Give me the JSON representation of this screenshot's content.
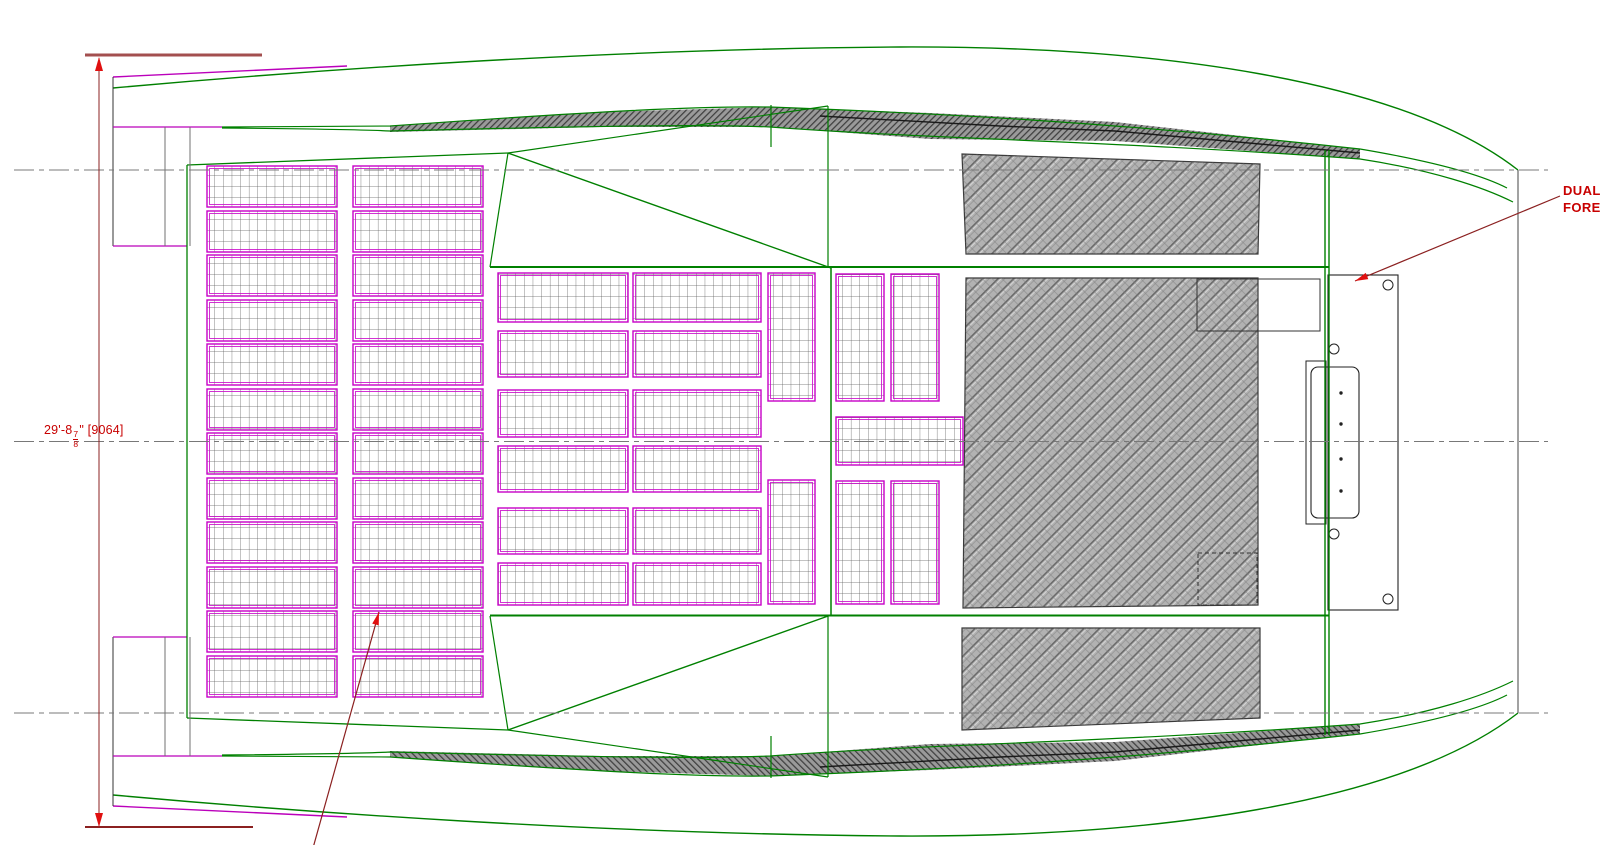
{
  "meta": {
    "width": 1600,
    "height": 845,
    "background": "#ffffff",
    "drawing_type": "catamaran deck plan CAD drawing"
  },
  "colors": {
    "hull_green": "#008000",
    "hull_magenta": "#BB00BB",
    "panel_magenta": "#C800C8",
    "dim_line": "#8B2020",
    "dim_bar": "#A34F4F",
    "arrow_red": "#E01010",
    "text_red": "#C80000",
    "centerline_gray": "#787878",
    "plate_black": "#222222",
    "hatch_base": "#b2b2b2",
    "hatch_dark_base": "#9a9a9a"
  },
  "texts": {
    "dim_whole": "29'-8",
    "dim_frac_num": "7",
    "dim_frac_den": "8",
    "dim_suffix": "\" [9064]",
    "callout_line1": "DUAL",
    "callout_line2": "FORE"
  },
  "centerlines": {
    "ys": [
      170,
      441.5,
      713
    ],
    "x1": 14,
    "x2": 1548,
    "dash": "20 5 5 5",
    "color": "#787878"
  },
  "dimension": {
    "vline": {
      "x": 99,
      "y1": 58,
      "y2": 826
    },
    "top_bar": {
      "x1": 85,
      "y1": 55,
      "x2": 262,
      "y2": 55,
      "sw": 3
    },
    "bottom_bar": {
      "x1": 85,
      "y1": 827,
      "x2": 253,
      "y2": 827,
      "sw": 2
    },
    "arrow_up": "99,57 95,71 103,71",
    "arrow_down": "99,827 95,813 103,813"
  },
  "leaders": [
    {
      "x1": 1560,
      "y1": 196,
      "x2": 1355,
      "y2": 281,
      "name": "leader-dual-fore"
    },
    {
      "x1": 313,
      "y1": 848,
      "x2": 379,
      "y2": 612,
      "name": "leader-deck-panel"
    }
  ],
  "panels": {
    "columns": [
      {
        "x": 207,
        "w": 130,
        "rows": [
          [
            166,
            41
          ],
          [
            211,
            41
          ],
          [
            255,
            41
          ],
          [
            300,
            41
          ],
          [
            344,
            41
          ],
          [
            389,
            41
          ],
          [
            433,
            41
          ],
          [
            478,
            41
          ],
          [
            522,
            41
          ],
          [
            567,
            41
          ],
          [
            611,
            41
          ],
          [
            656,
            41
          ]
        ]
      },
      {
        "x": 353,
        "w": 130,
        "rows": [
          [
            166,
            41
          ],
          [
            211,
            41
          ],
          [
            255,
            41
          ],
          [
            300,
            41
          ],
          [
            344,
            41
          ],
          [
            389,
            41
          ],
          [
            433,
            41
          ],
          [
            478,
            41
          ],
          [
            522,
            41
          ],
          [
            567,
            41
          ],
          [
            611,
            41
          ],
          [
            656,
            41
          ]
        ]
      },
      {
        "x": 498,
        "w": 130,
        "rows": [
          [
            273,
            49
          ],
          [
            331,
            46
          ],
          [
            390,
            47
          ],
          [
            446,
            46
          ],
          [
            508,
            46
          ],
          [
            563,
            42
          ]
        ]
      },
      {
        "x": 633,
        "w": 128,
        "rows": [
          [
            273,
            49
          ],
          [
            331,
            46
          ],
          [
            390,
            47
          ],
          [
            446,
            46
          ],
          [
            508,
            46
          ],
          [
            563,
            42
          ]
        ]
      },
      {
        "x": 768,
        "w": 47,
        "rows": [
          [
            273,
            128
          ],
          [
            480,
            124
          ]
        ]
      },
      {
        "x": 836,
        "w": 48,
        "rows": [
          [
            274,
            127
          ],
          [
            481,
            123
          ]
        ]
      },
      {
        "x": 891,
        "w": 48,
        "rows": [
          [
            274,
            127
          ],
          [
            481,
            123
          ]
        ]
      }
    ],
    "singles": [
      {
        "x": 836,
        "y": 417,
        "w": 127,
        "h": 48
      }
    ]
  },
  "gray_regions": [
    {
      "pts": "962,154 1260,164 1258,254 966,254",
      "name": "roof-hatch-top"
    },
    {
      "pts": "966,278 1258,278 1258,605 963,608",
      "name": "roof-hatch-main"
    },
    {
      "pts": "962,628 1260,628 1260,718 962,730",
      "name": "roof-hatch-bottom"
    }
  ],
  "hull": {
    "mirror_axis": 883,
    "half_elements": [
      {
        "t": "polygon",
        "pts": "390,126 600,112 770,107 930,113 1115,122 1360,149 1360,159 1115,141 930,139 770,127 600,127 390,132",
        "f": "url(#pHatchD)",
        "n": "sidedeck-hatch"
      },
      {
        "t": "polyline",
        "pts": "820,116 1000,126 1115,131 1360,153",
        "s": "#1a1a1a",
        "sw": 1.4,
        "n": "sidedeck-edge-line"
      },
      {
        "t": "path",
        "d": "M113,88 C300,71 600,49 900,47 C1150,46 1400,78 1518,170",
        "s": "#008000",
        "sw": 1.4,
        "n": "hull-sheer-line"
      },
      {
        "t": "line",
        "x1": 113,
        "y1": 77,
        "x2": 347,
        "y2": 66,
        "s": "#BB00BB",
        "sw": 1.4,
        "n": "hull-sheer-magenta"
      },
      {
        "t": "path",
        "d": "M222,127 C330,126 370,126 390,126 C600,111 700,106 770,107 C930,113 1115,122 1360,149 C1425,160 1478,173 1507,188",
        "s": "#008000",
        "sw": 1.2,
        "n": "hull-inner-line"
      },
      {
        "t": "path",
        "d": "M222,128 C330,129 370,130 390,131 C600,126 700,124 770,127 C930,139 1115,141 1360,159 C1432,170 1483,187 1513,202",
        "s": "#008000",
        "sw": 1.2,
        "n": "hull-inner-line"
      },
      {
        "t": "line",
        "x1": 187,
        "y1": 165,
        "x2": 508,
        "y2": 153,
        "s": "#008000",
        "sw": 1.3,
        "n": "deck-edge-line"
      },
      {
        "t": "line",
        "x1": 508,
        "y1": 153,
        "x2": 490,
        "y2": 267,
        "s": "#008000",
        "sw": 1.2,
        "n": "deck-brace-line"
      },
      {
        "t": "line",
        "x1": 508,
        "y1": 153,
        "x2": 831,
        "y2": 268,
        "s": "#008000",
        "sw": 1.4,
        "n": "deck-diagonal-line"
      },
      {
        "t": "line",
        "x1": 508,
        "y1": 153,
        "x2": 828,
        "y2": 106,
        "s": "#008000",
        "sw": 1.2,
        "n": "deck-brace-line"
      },
      {
        "t": "line",
        "x1": 828,
        "y1": 106,
        "x2": 828,
        "y2": 267,
        "s": "#008000",
        "sw": 1.2,
        "n": "beam-edge-line"
      },
      {
        "t": "line",
        "x1": 113,
        "y1": 77,
        "x2": 113,
        "y2": 246,
        "s": "#333333",
        "sw": 1,
        "n": "transom-line"
      },
      {
        "t": "line",
        "x1": 113,
        "y1": 127,
        "x2": 222,
        "y2": 127,
        "s": "#BB00BB",
        "sw": 1.3,
        "n": "transom-magenta-line"
      },
      {
        "t": "line",
        "x1": 113,
        "y1": 246,
        "x2": 187,
        "y2": 246,
        "s": "#BB00BB",
        "sw": 1.3,
        "n": "transom-magenta-line"
      },
      {
        "t": "line",
        "x1": 165,
        "y1": 127,
        "x2": 165,
        "y2": 246,
        "s": "#707070",
        "sw": 1,
        "n": "transom-divider"
      },
      {
        "t": "line",
        "x1": 190,
        "y1": 127,
        "x2": 190,
        "y2": 246,
        "s": "#707070",
        "sw": 1,
        "n": "transom-divider"
      },
      {
        "t": "line",
        "x1": 771,
        "y1": 105,
        "x2": 771,
        "y2": 147,
        "s": "#008000",
        "sw": 1.2,
        "n": "beam-crossing-mark"
      }
    ],
    "static_elements": [
      {
        "t": "line",
        "x1": 187,
        "y1": 165,
        "x2": 187,
        "y2": 718,
        "s": "#008000",
        "sw": 1.3,
        "n": "deck-left-edge"
      },
      {
        "t": "line",
        "x1": 490,
        "y1": 267,
        "x2": 1329,
        "y2": 267,
        "s": "#008000",
        "sw": 2,
        "n": "deck-top-edge"
      },
      {
        "t": "line",
        "x1": 490,
        "y1": 615.5,
        "x2": 1329,
        "y2": 615.5,
        "s": "#008000",
        "sw": 2,
        "n": "deck-bottom-edge"
      },
      {
        "t": "line",
        "x1": 831,
        "y1": 267,
        "x2": 831,
        "y2": 616,
        "s": "#008000",
        "sw": 1.5,
        "n": "mast-beam-line"
      },
      {
        "t": "line",
        "x1": 1518,
        "y1": 170,
        "x2": 1518,
        "y2": 713,
        "s": "#444444",
        "sw": 1,
        "n": "bow-tip-line"
      }
    ],
    "beam_lines": [
      {
        "t": "line",
        "x1": 1325,
        "y1": 150,
        "x2": 1325,
        "y2": 735,
        "s": "#008000",
        "sw": 1.4,
        "n": "forward-beam-line"
      },
      {
        "t": "line",
        "x1": 1329,
        "y1": 150,
        "x2": 1329,
        "y2": 735,
        "s": "#008000",
        "sw": 1.4,
        "n": "forward-beam-line"
      }
    ]
  },
  "plate": {
    "elements": [
      {
        "t": "rect",
        "x": 1328,
        "y": 275,
        "w": 70,
        "h": 335,
        "f": "#ffffff",
        "s": "#222222",
        "sw": 1.1,
        "n": "bow-plate"
      },
      {
        "t": "rect",
        "x": 1197,
        "y": 279,
        "w": 123,
        "h": 52,
        "s": "#333333",
        "sw": 1,
        "n": "hatch-opening-outline"
      },
      {
        "t": "rect",
        "x": 1198,
        "y": 553,
        "w": 59,
        "h": 52,
        "s": "#333333",
        "sw": 1,
        "dash": "4 3",
        "n": "hidden-opening-outline"
      },
      {
        "t": "rect",
        "x": 1306,
        "y": 361,
        "w": 20,
        "h": 163,
        "s": "#222222",
        "sw": 1,
        "n": "bracket-outline"
      },
      {
        "t": "rect",
        "x": 1311,
        "y": 367,
        "w": 48,
        "h": 151,
        "rx": 7,
        "s": "#222222",
        "sw": 1.1,
        "n": "bracket-pad"
      },
      {
        "t": "circle",
        "cx": 1388,
        "cy": 285,
        "r": 5,
        "f": "#ffffff",
        "s": "#222222",
        "sw": 1,
        "n": "bolt-hole"
      },
      {
        "t": "circle",
        "cx": 1334,
        "cy": 349,
        "r": 5,
        "f": "#ffffff",
        "s": "#222222",
        "sw": 1,
        "n": "bolt-hole"
      },
      {
        "t": "circle",
        "cx": 1334,
        "cy": 534,
        "r": 5,
        "f": "#ffffff",
        "s": "#222222",
        "sw": 1,
        "n": "bolt-hole"
      },
      {
        "t": "circle",
        "cx": 1388,
        "cy": 599,
        "r": 5,
        "f": "#ffffff",
        "s": "#222222",
        "sw": 1,
        "n": "bolt-hole"
      },
      {
        "t": "circle",
        "cx": 1341,
        "cy": 393,
        "r": 1.7,
        "f": "#222222",
        "s": "none",
        "sw": 0,
        "n": "fastener-dot"
      },
      {
        "t": "circle",
        "cx": 1341,
        "cy": 424,
        "r": 1.7,
        "f": "#222222",
        "s": "none",
        "sw": 0,
        "n": "fastener-dot"
      },
      {
        "t": "circle",
        "cx": 1341,
        "cy": 459,
        "r": 1.7,
        "f": "#222222",
        "s": "none",
        "sw": 0,
        "n": "fastener-dot"
      },
      {
        "t": "circle",
        "cx": 1341,
        "cy": 491,
        "r": 1.7,
        "f": "#222222",
        "s": "none",
        "sw": 0,
        "n": "fastener-dot"
      }
    ]
  }
}
